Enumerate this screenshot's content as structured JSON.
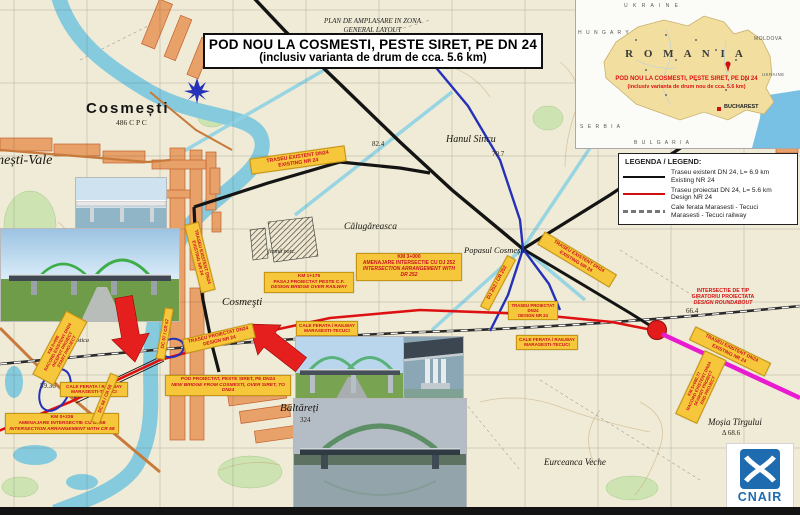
{
  "title": {
    "line1": "PLAN DE AMPLASARE IN ZONA",
    "line2": "GENERAL LAYOUT",
    "line3": "POD NOU LA COSMESTI, PESTE SIRET, PE DN 24",
    "line4": "(inclusiv varianta de drum de cca. 5.6 km)"
  },
  "inset": {
    "ukraine_top": "U K R A I N E",
    "hungary": "H U N G A R Y",
    "moldova": "MOLDOVA",
    "ukraine_right": "UKRAINE",
    "serbia": "S E R B I A",
    "bulgaria": "B U L G A R I A",
    "country": "R O M A N I A",
    "note1": "POD NOU LA COSMESTI, PESTE SIRET,  PE DN 24",
    "note2": "(inclusiv varianta de drum nou de cca. 5.6 km)",
    "capital": "BUCHAREST"
  },
  "legend": {
    "title": "LEGENDA / LEGEND:",
    "items": [
      {
        "label1": "Traseu existent DN 24, L= 6.9 km",
        "label2": "Existing NR 24"
      },
      {
        "label1": "Traseu proiectat DN 24, L= 5.6 km",
        "label2": "Design NR 24"
      },
      {
        "label1": "Cale ferata Marasesti - Tecuci",
        "label2": "Marasesti - Tecuci railway"
      }
    ]
  },
  "callouts": {
    "traseu_existent_top": {
      "l1": "TRASEU EXISTENT DN24",
      "l2": "EXISTING NR 24"
    },
    "traseu_existent_village": {
      "l1": "TRASEU EXISTENT DN24",
      "l2": "EXISTING NR 24"
    },
    "traseu_existent_mid": {
      "l1": "TRASEU EXISTENT DN24",
      "l2": "EXISTING NR 24"
    },
    "traseu_existent_right": {
      "l1": "TRASEU EXISTENT DN24",
      "l2": "EXISTING NR 24"
    },
    "traseu_proiectat_left": {
      "l1": "TRASEU PROIECTAT DN24",
      "l2": "DESIGN NR 24"
    },
    "traseu_proiectat_right": {
      "l1": "TRASEU PROIECTAT DN24",
      "l2": "DESIGN NR 24"
    },
    "km3000": {
      "l1": "KM 3+000",
      "l2": "AMENAJARE INTERSECTIE CU DJ 252",
      "l3": "INTERSECTION ARRANGEMENT WITH DR 252"
    },
    "pasaj": {
      "l1": "KM 1+175",
      "l2": "PASAJ PROIECTAT PESTE C.F.",
      "l3": "DESIGN BRIDGE OVER RAILWAY"
    },
    "pod": {
      "l1": "POD PROIECTAT, PESTE SIRET, PE DN24",
      "l2": "NEW BRIDGE FROM COSMESTI, OVER SIRET, TO DN24"
    },
    "km0226": {
      "l1": "KM 0+226",
      "l2": "AMENAJARE INTERSECTIE CU DC58",
      "l3": "INTERSECTION ARRANGEMENT WITH CR 58"
    },
    "start": {
      "l1": "KM 0+000",
      "l2": "RACORD EXISTENT DN24",
      "l3": "INCEPUT PROIECT",
      "l4": "START PROJECT"
    },
    "end": {
      "l1": "KM 5+680.77",
      "l2": "RACORD EXISTENT DN24",
      "l3": "SFARSIT PROIECT",
      "l4": "END PROJECT"
    },
    "cale_ferata_left": {
      "l1": "CALE FERATA / RAILWAY",
      "l2": "MARASESTI-TECUCI"
    },
    "cale_ferata_mid": {
      "l1": "CALE FERATA / RAILWAY",
      "l2": "MARASESTI-TECUCI"
    },
    "cale_ferata_right": {
      "l1": "CALE FERATA / RAILWAY",
      "l2": "MARASESTI-TECUCI"
    },
    "giratoriu": {
      "l1": "INTERSECTIE DE TIP",
      "l2": "GIRATORIU PROIECTATA",
      "l3": "DESIGN ROUNDABOUT"
    },
    "dj252": {
      "l1": "DJ 252 / CR 252"
    },
    "dc57": {
      "l1": "DC 57 / CR 57"
    },
    "dc58": {
      "l1": "DC 58 / CR 58"
    }
  },
  "places": {
    "cosmesti_town": "Cosmești",
    "cosmesti_code": "486 C P C",
    "vale": "mești-Vale",
    "cosmesti_village": "Cosmeşti",
    "baltareti": "Băltăreți",
    "baltareti_elev": "324",
    "hanul": "Hanul Sincu",
    "popasul": "Popasul Cosmești",
    "calugareasca": "Călugăreasca",
    "mosia": "Moșia Tîrgului",
    "mosia_elev": "Δ 68.6",
    "eurceanca": "Eurceanca Veche",
    "ferma": "fermă porc.",
    "zona": "zona turistica",
    "elev1": "59.36",
    "elev2": "70.7",
    "elev3": "82.4",
    "elev4": "66.4",
    "north": "N"
  },
  "logo": {
    "text": "CNAIR"
  },
  "colors": {
    "label_bg": "#F7C73B",
    "label_text": "#CC1122",
    "route_new": "#DD1111",
    "route_existing": "#141414",
    "route_blue": "#2431B8",
    "magenta": "#E91BD0",
    "roundabout": "#E31B1B",
    "water": "#86CBDD",
    "built_up": "#E8A168",
    "logo_blue": "#1E6BB0"
  }
}
